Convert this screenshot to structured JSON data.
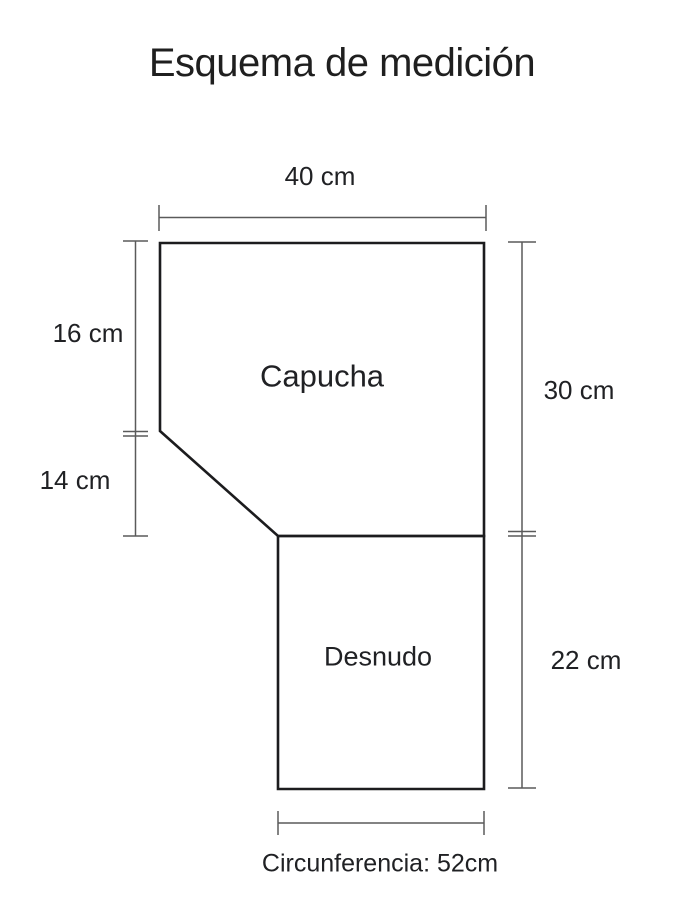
{
  "title": "Esquema de medición",
  "sections": {
    "capucha": {
      "label": "Capucha"
    },
    "desnudo": {
      "label": "Desnudo"
    }
  },
  "measurements": {
    "top_width": "40 cm",
    "left_upper": "16 cm",
    "left_lower": "14 cm",
    "right_upper": "30 cm",
    "right_lower": "22 cm",
    "bottom_circumference": "Circunferencia: 52cm"
  },
  "colors": {
    "outline": "#1c1c1e",
    "dimension_line": "#5a5a5a",
    "text": "#202124",
    "background": "#ffffff"
  }
}
